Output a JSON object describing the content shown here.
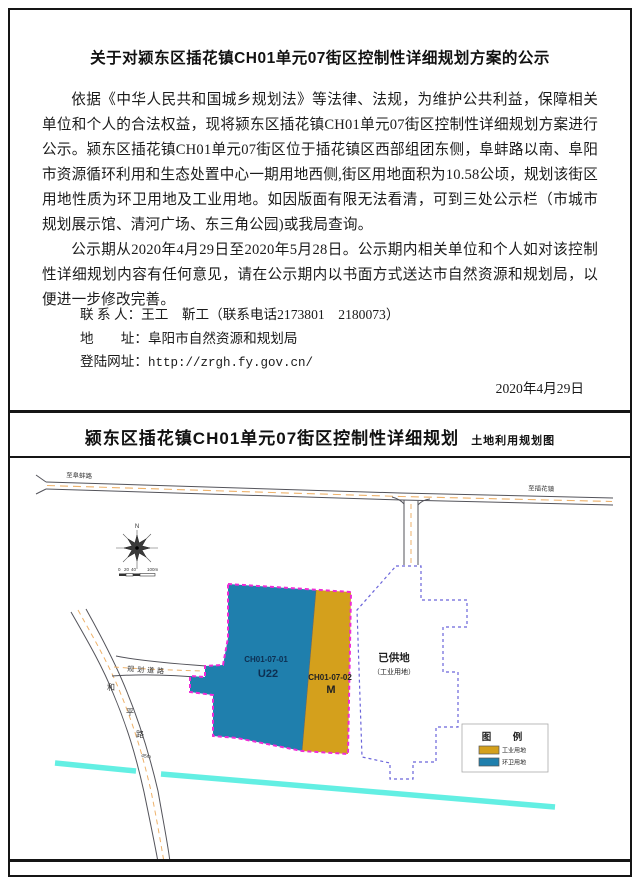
{
  "notice": {
    "title": "关于对颍东区插花镇CH01单元07街区控制性详细规划方案的公示",
    "paragraphs": [
      "依据《中华人民共和国城乡规划法》等法律、法规，为维护公共利益，保障相关单位和个人的合法权益，现将颍东区插花镇CH01单元07街区控制性详细规划方案进行公示。颍东区插花镇CH01单元07街区位于插花镇区西部组团东侧，阜蚌路以南、阜阳市资源循环利用和生态处置中心一期用地西侧,街区用地面积为10.58公顷，规划该街区用地性质为环卫用地及工业用地。如因版面有限无法看清，可到三处公示栏（市城市规划展示馆、清河广场、东三角公园)或我局查询。",
      "公示期从2020年4月29日至2020年5月28日。公示期内相关单位和个人如对该控制性详细规划内容有任何意见，请在公示期内以书面方式送达市自然资源和规划局，以便进一步修改完善。"
    ],
    "contact_rows": [
      {
        "label": "联 系 人：",
        "value": "王工　靳工（联系电话2173801　2180073）"
      },
      {
        "label": "地　　址：",
        "value": "阜阳市自然资源和规划局"
      },
      {
        "label": "登陆网址：",
        "value": "http://zrgh.fy.gov.cn/"
      }
    ],
    "date": "2020年4月29日"
  },
  "map": {
    "title": "颍东区插花镇CH01单元07街区控制性详细规划",
    "subtitle": "土地利用规划图",
    "labels": {
      "road_left": "至阜蚌路",
      "road_right": "至插花镇",
      "planned_road": "规划道路",
      "heping_road": "和平路",
      "north": "N",
      "width_dim": "45m",
      "parcel1_code": "CH01-07-01",
      "parcel1_use": "U22",
      "parcel2_code": "CH01-07-02",
      "parcel2_use": "M",
      "supplied": "已供地",
      "supplied_sub": "（工业用地）",
      "scale": [
        "0",
        "20",
        "40",
        "100m"
      ]
    },
    "legend": {
      "title": "图　例",
      "items": [
        {
          "label": "工业用地",
          "color": "#d4a01c"
        },
        {
          "label": "环卫用地",
          "color": "#1f7fad"
        }
      ]
    },
    "colors": {
      "industrial": "#d4a01c",
      "sanitation": "#1f7fad",
      "block_border": "#ef2bd6",
      "supplied_border": "#6a64da",
      "river": "#63efe3",
      "road_center": "#eeb26b",
      "road_casing": "#53535a"
    }
  }
}
